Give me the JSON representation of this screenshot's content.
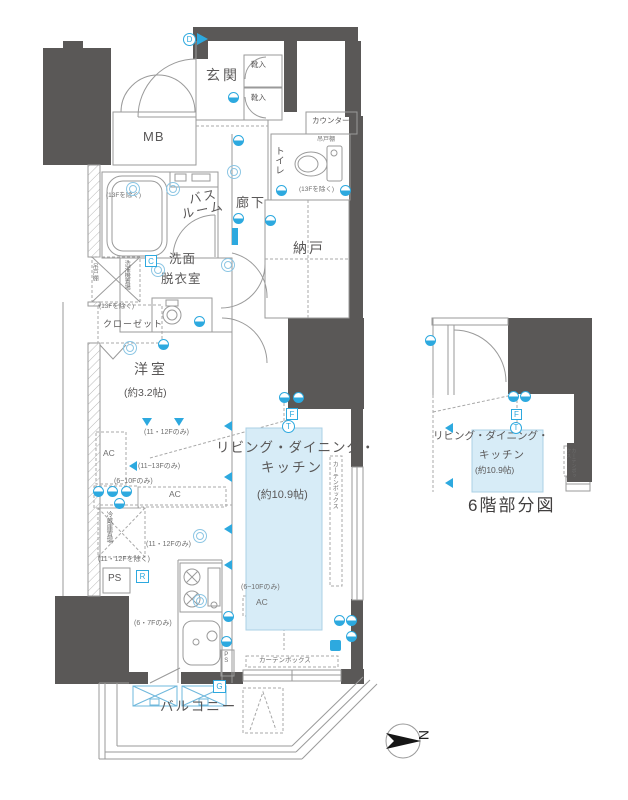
{
  "colors": {
    "wall": "#5a5857",
    "line": "#9a9a9a",
    "accent_blue": "#2da9df",
    "ldk_fill": "#d7ecf7",
    "text": "#595757"
  },
  "labels": {
    "genkan": "玄関",
    "shoe": "靴入",
    "mb": "MB",
    "counter": "カウンター",
    "tsuridana": "吊戸棚",
    "toilet": "トイレ",
    "except13f": "(13Fを除く)",
    "hallway": "廊下",
    "bath1": "バス",
    "bath2": "ルーム",
    "storage": "納戸",
    "wash1": "洗面",
    "wash2": "脱衣室",
    "laundry": "洗濯機置場",
    "closet": "クローゼット",
    "western": "洋室",
    "western_size": "(約3.2帖)",
    "ldk1": "リビング・ダイニング・",
    "ldk2": "キッチン",
    "ldk_size": "(約10.9帖)",
    "fridge": "冷蔵庫置場",
    "ps": "PS",
    "ac": "AC",
    "balcony": "バルコニー",
    "curtain": "カーテンボックス",
    "only_11_12": "(11・12Fのみ)",
    "only_11_13": "(11~13Fのみ)",
    "only_6_10": "(6~10Fのみ)",
    "except_11_12": "(11・12Fを除く)",
    "only_6_7": "(6・7Fのみ)"
  },
  "letters": {
    "c": "C",
    "d": "D",
    "r": "R",
    "g": "G",
    "f": "F",
    "t": "T"
  },
  "sub_plan": {
    "caption": "6階部分図"
  },
  "compass": {
    "north": "N"
  }
}
